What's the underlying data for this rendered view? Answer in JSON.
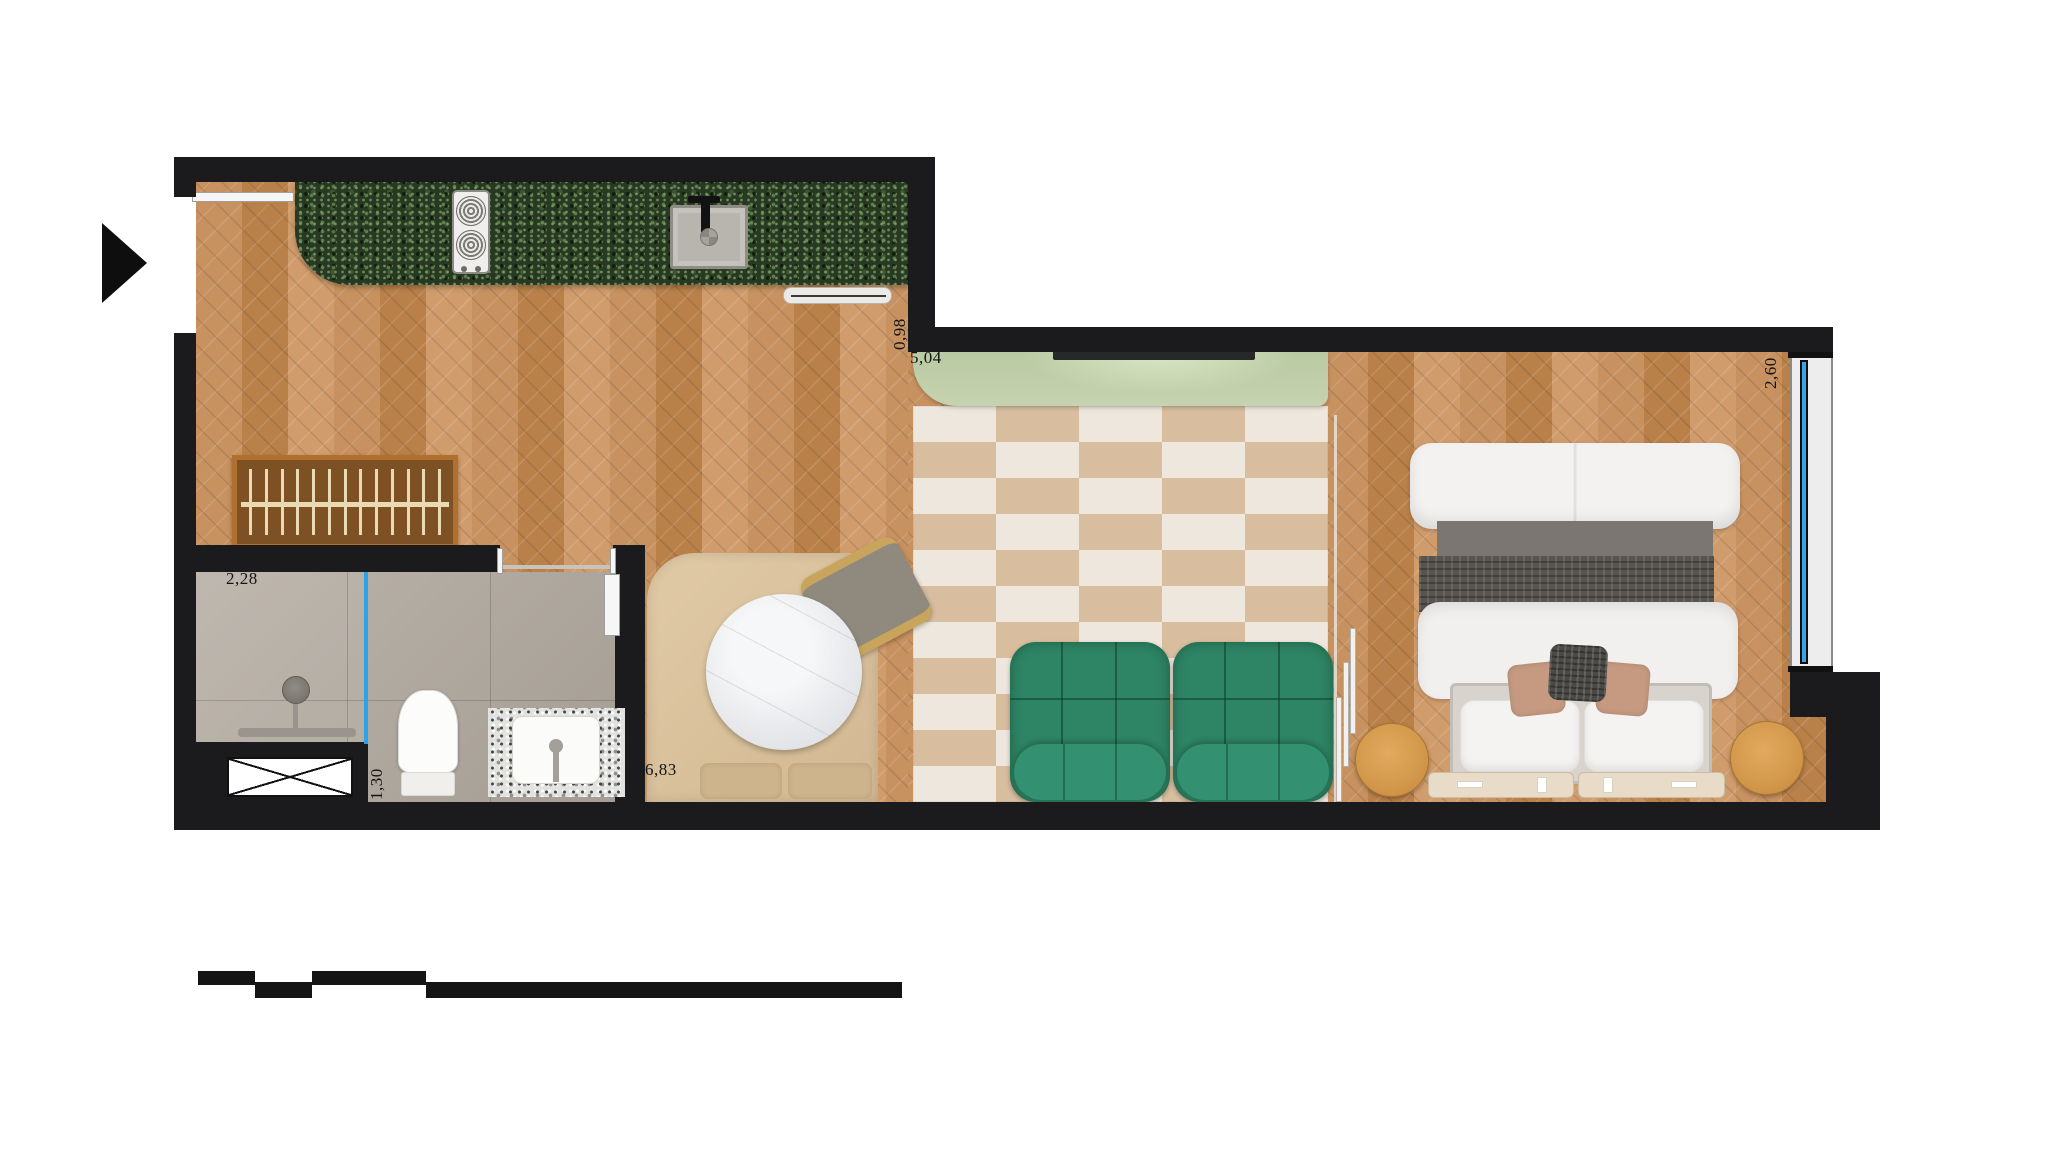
{
  "title": "Studio apartment floor plan",
  "dims": {
    "bath_width": "2,28",
    "bath_niche": "1,30",
    "hall_length": "6,83",
    "living_length": "5,04",
    "living_offset": "0,98",
    "window_width": "2,60"
  },
  "icons": {
    "entry_arrow": "solid right-pointing triangle marker",
    "shaft_box": "crossed rectangle (technical shaft)"
  },
  "colors": {
    "wall": "#1b1b1d",
    "wood_floor": "#c4905f",
    "kitchen_granite": "#263a21",
    "rug_beige": "#d8bd9f",
    "rug_cream": "#eee7dd",
    "sideboard_green": "#bccaa6",
    "sofa_green": "#2e8565",
    "stool_wood": "#d79b52",
    "glass_blue": "#2aa3e8",
    "banquette_beige": "#d9c29c",
    "bath_tile": "#b3aba0"
  }
}
